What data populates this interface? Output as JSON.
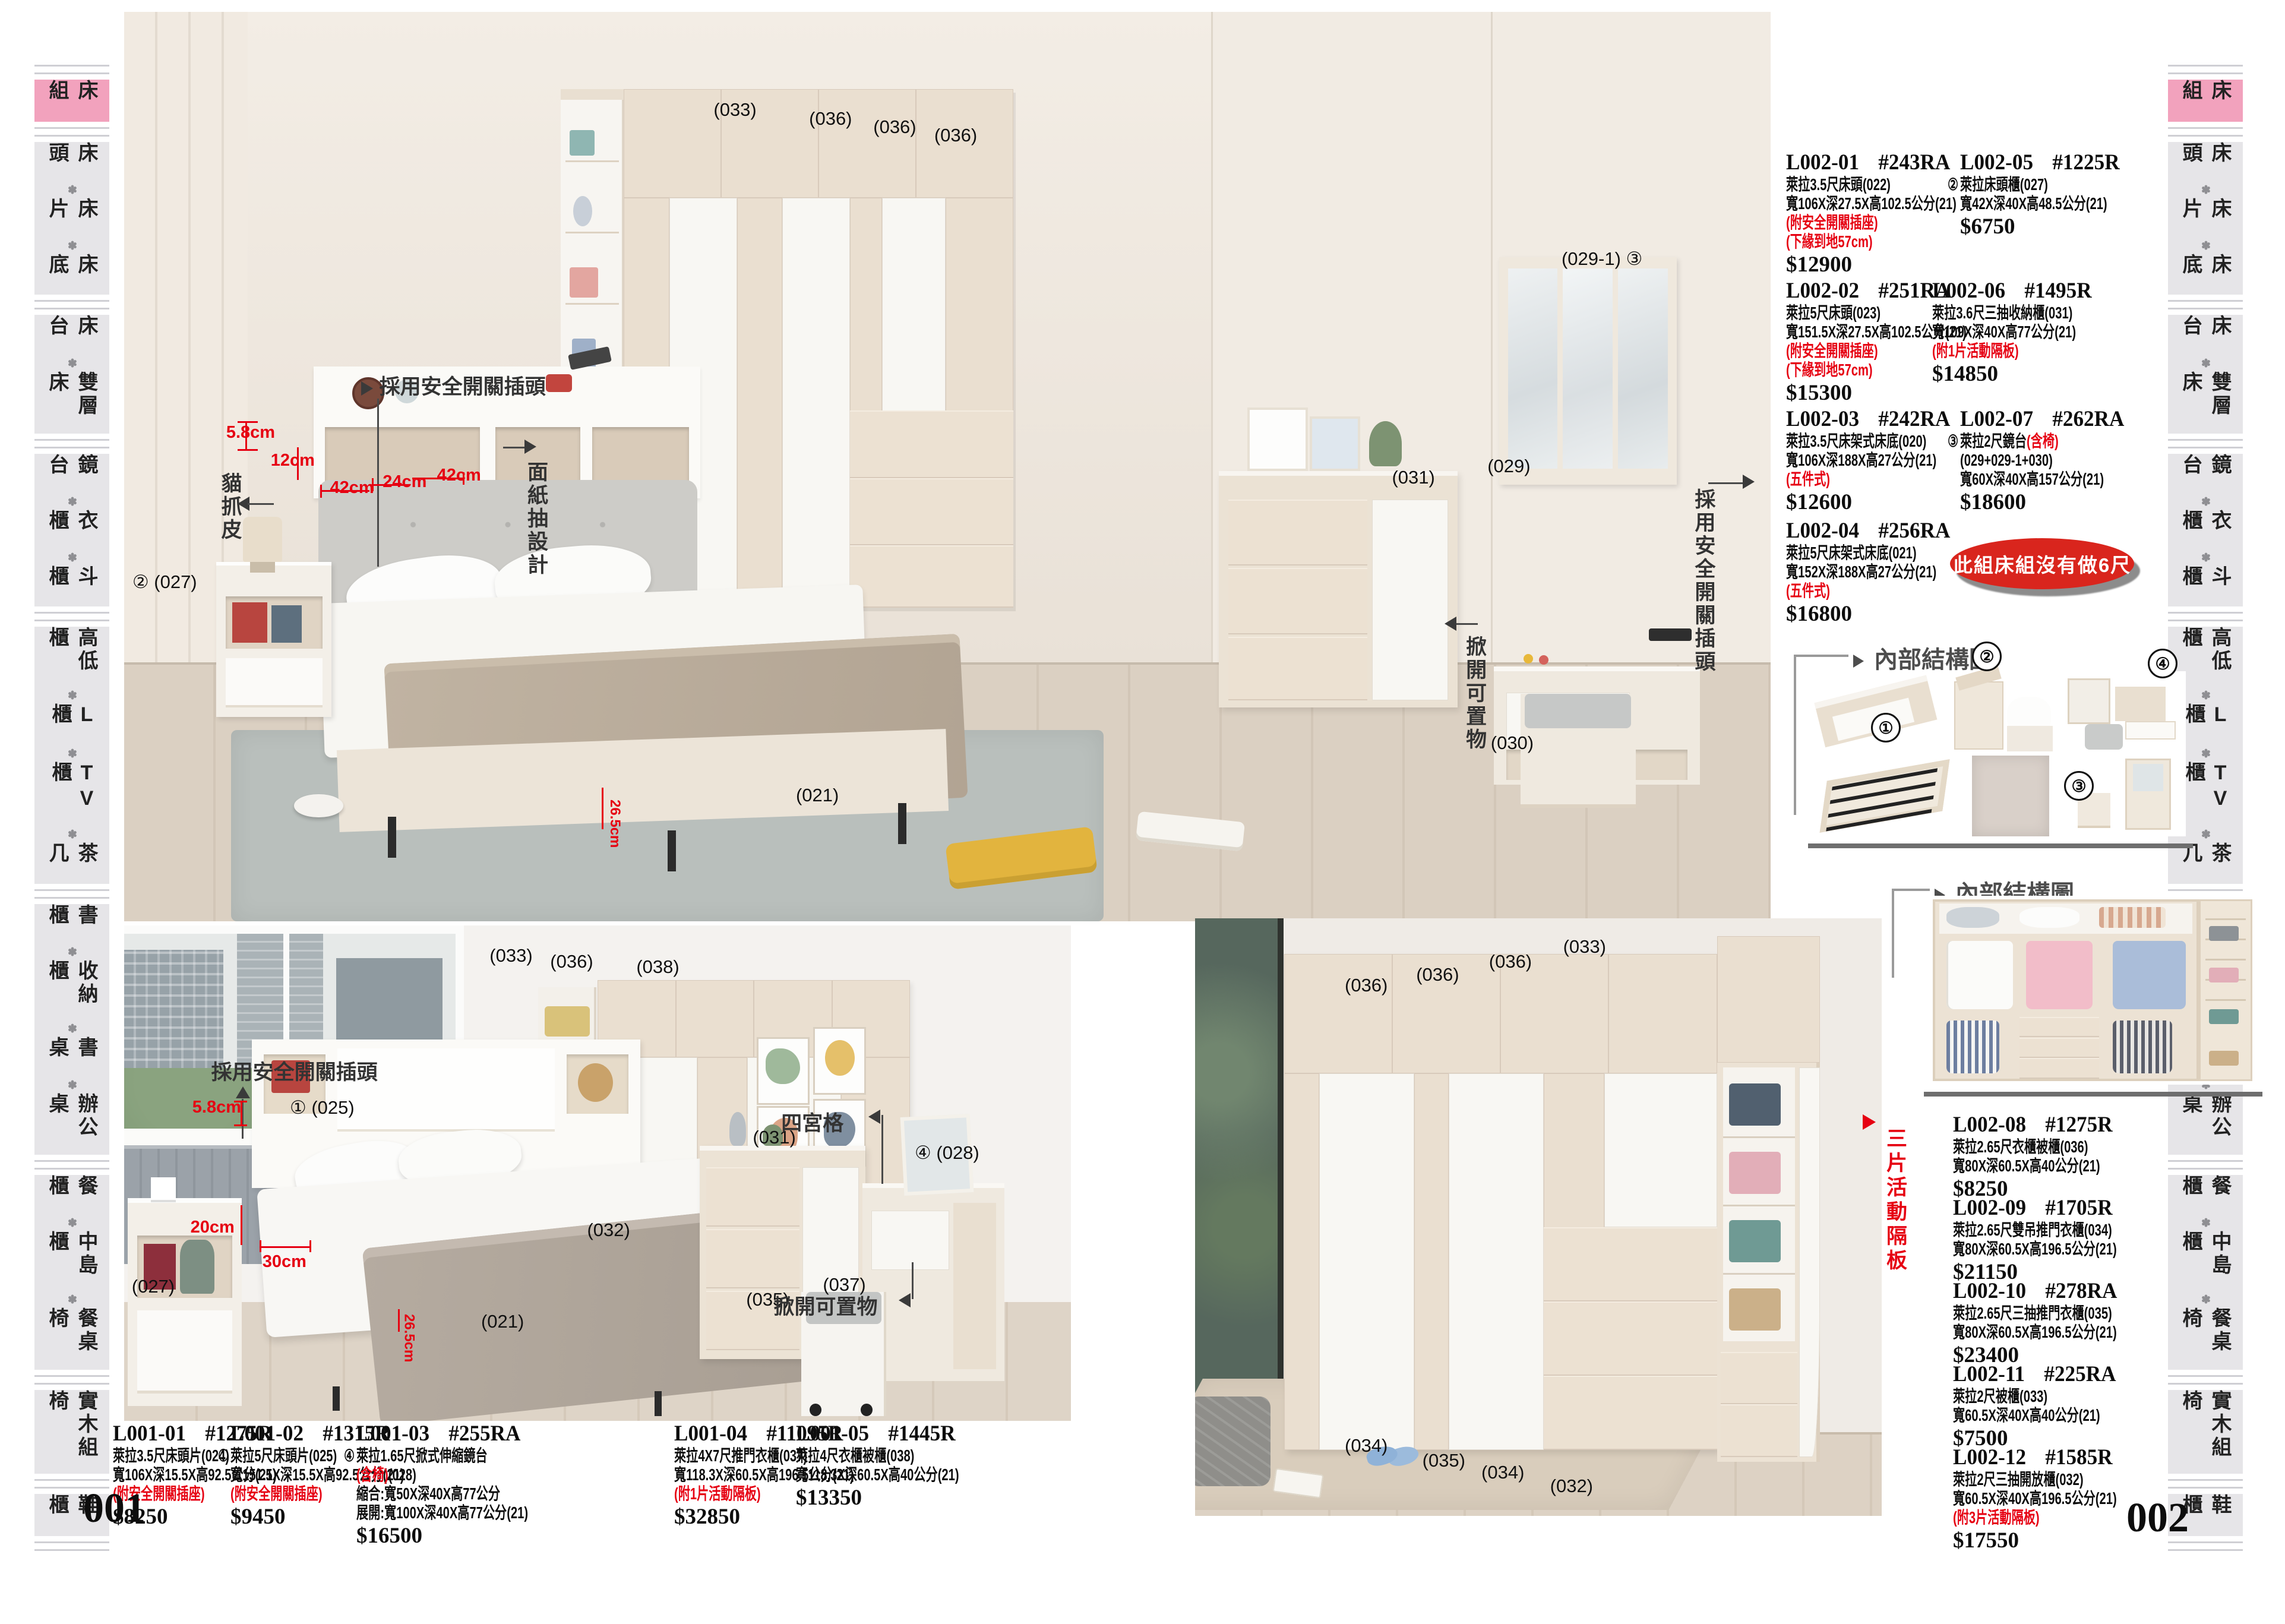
{
  "accent_colors": {
    "red": "#e60012",
    "pink": "#f2a2bd",
    "badge_red": "#d9251d"
  },
  "pages": {
    "left_number": "001",
    "right_number": "002"
  },
  "sidebar": {
    "separator": "✽",
    "items": [
      {
        "label": "床組",
        "active": true
      },
      {
        "label": "床頭✽床片✽床底",
        "active": false
      },
      {
        "label": "床台✽雙層床",
        "active": false
      },
      {
        "label": "鏡台✽衣櫃✽斗櫃",
        "active": false
      },
      {
        "label": "高低櫃✽L櫃✽TV櫃✽茶几",
        "active": false
      },
      {
        "label": "書櫃✽收納櫃✽書桌✽辦公桌",
        "active": false
      },
      {
        "label": "餐櫃✽中島櫃✽餐桌椅",
        "active": false
      },
      {
        "label": "實木組椅",
        "active": false
      },
      {
        "label": "鞋櫃",
        "active": false
      }
    ]
  },
  "products_l001": [
    {
      "code": "L001-01",
      "model": "#1275R",
      "lines": [
        {
          "segs": [
            {
              "t": "萊拉3.5尺床頭片(024)"
            }
          ]
        },
        {
          "segs": [
            {
              "t": "寬106X深15.5X高92.5公分(21)"
            }
          ]
        },
        {
          "segs": [
            {
              "t": "(附安全開關插座)",
              "red": true
            }
          ]
        }
      ],
      "price": "$8250"
    },
    {
      "code": "L001-02",
      "model": "#1315R",
      "lines": [
        {
          "circ": "①",
          "segs": [
            {
              "t": "萊拉5尺床頭片(025)"
            }
          ]
        },
        {
          "segs": [
            {
              "t": "寬151.5X深15.5X高92.5公分(21)"
            }
          ]
        },
        {
          "segs": [
            {
              "t": "(附安全開關插座)",
              "red": true
            }
          ]
        }
      ],
      "price": "$9450"
    },
    {
      "code": "L001-03",
      "model": "#255RA",
      "lines": [
        {
          "circ": "④",
          "segs": [
            {
              "t": "萊拉1.65尺掀式伸縮鏡台"
            }
          ]
        },
        {
          "segs": [
            {
              "t": "(含椅)",
              "red": true
            },
            {
              "t": "(028)"
            }
          ]
        },
        {
          "segs": [
            {
              "t": "縮合:寬50X深40X高77公分"
            }
          ]
        },
        {
          "segs": [
            {
              "t": "展開:寬100X深40X高77公分(21)"
            }
          ]
        }
      ],
      "price": "$16500"
    },
    {
      "code": "L001-04",
      "model": "#11095R",
      "lines": [
        {
          "segs": [
            {
              "t": "萊拉4X7尺推門衣櫃(037)"
            }
          ]
        },
        {
          "segs": [
            {
              "t": "寬118.3X深60.5X高196.5公分(21)"
            }
          ]
        },
        {
          "segs": [
            {
              "t": "(附1片活動隔板)",
              "red": true
            }
          ]
        }
      ],
      "price": "$32850"
    },
    {
      "code": "L001-05",
      "model": "#1445R",
      "lines": [
        {
          "segs": [
            {
              "t": "萊拉4尺衣櫃被櫃(038)"
            }
          ]
        },
        {
          "segs": [
            {
              "t": "寬118.3X深60.5X高40公分(21)"
            }
          ]
        }
      ],
      "price": "$13350"
    }
  ],
  "products_l002_main": [
    {
      "code": "L002-01",
      "model": "#243RA",
      "lines": [
        {
          "segs": [
            {
              "t": "萊拉3.5尺床頭(022)"
            }
          ]
        },
        {
          "segs": [
            {
              "t": "寬106X深27.5X高102.5公分(21)"
            }
          ]
        },
        {
          "segs": [
            {
              "t": "(附安全開關插座)",
              "red": true
            }
          ]
        },
        {
          "segs": [
            {
              "t": "(下緣到地57cm)",
              "red": true
            }
          ]
        }
      ],
      "price": "$12900"
    },
    {
      "code": "L002-05",
      "model": "#1225R",
      "lines": [
        {
          "circ": "②",
          "segs": [
            {
              "t": "萊拉床頭櫃(027)"
            }
          ]
        },
        {
          "segs": [
            {
              "t": "寬42X深40X高48.5公分(21)"
            }
          ]
        }
      ],
      "price": "$6750"
    },
    {
      "code": "L002-02",
      "model": "#251RA",
      "lines": [
        {
          "segs": [
            {
              "t": "萊拉5尺床頭(023)"
            }
          ]
        },
        {
          "segs": [
            {
              "t": "寬151.5X深27.5X高102.5公分(21)"
            }
          ]
        },
        {
          "segs": [
            {
              "t": "(附安全開關插座)",
              "red": true
            }
          ]
        },
        {
          "segs": [
            {
              "t": "(下緣到地57cm)",
              "red": true
            }
          ]
        }
      ],
      "price": "$15300"
    },
    {
      "code": "L002-06",
      "model": "#1495R",
      "lines": [
        {
          "segs": [
            {
              "t": "萊拉3.6尺三抽收納櫃(031)"
            }
          ]
        },
        {
          "segs": [
            {
              "t": "寬109X深40X高77公分(21)"
            }
          ]
        },
        {
          "segs": [
            {
              "t": "(附1片活動隔板)",
              "red": true
            }
          ]
        }
      ],
      "price": "$14850"
    },
    {
      "code": "L002-03",
      "model": "#242RA",
      "lines": [
        {
          "segs": [
            {
              "t": "萊拉3.5尺床架式床底(020)"
            }
          ]
        },
        {
          "segs": [
            {
              "t": "寬106X深188X高27公分(21)"
            }
          ]
        },
        {
          "segs": [
            {
              "t": "(五件式)",
              "red": true
            }
          ]
        }
      ],
      "price": "$12600"
    },
    {
      "code": "L002-07",
      "model": "#262RA",
      "lines": [
        {
          "circ": "③",
          "segs": [
            {
              "t": "萊拉2尺鏡台"
            },
            {
              "t": "(含椅)",
              "red": true
            }
          ]
        },
        {
          "segs": [
            {
              "t": "(029+029-1+030)"
            }
          ]
        },
        {
          "segs": [
            {
              "t": "寬60X深40X高157公分(21)"
            }
          ]
        }
      ],
      "price": "$18600"
    },
    {
      "code": "L002-04",
      "model": "#256RA",
      "lines": [
        {
          "segs": [
            {
              "t": "萊拉5尺床架式床底(021)"
            }
          ]
        },
        {
          "segs": [
            {
              "t": "寬152X深188X高27公分(21)"
            }
          ]
        },
        {
          "segs": [
            {
              "t": "(五件式)",
              "red": true
            }
          ]
        }
      ],
      "price": "$16800"
    }
  ],
  "products_l002_side": [
    {
      "code": "L002-08",
      "model": "#1275R",
      "lines": [
        {
          "segs": [
            {
              "t": "萊拉2.65尺衣櫃被櫃(036)"
            }
          ]
        },
        {
          "segs": [
            {
              "t": "寬80X深60.5X高40公分(21)"
            }
          ]
        }
      ],
      "price": "$8250"
    },
    {
      "code": "L002-09",
      "model": "#1705R",
      "lines": [
        {
          "segs": [
            {
              "t": "萊拉2.65尺雙吊推門衣櫃(034)"
            }
          ]
        },
        {
          "segs": [
            {
              "t": "寬80X深60.5X高196.5公分(21)"
            }
          ]
        }
      ],
      "price": "$21150"
    },
    {
      "code": "L002-10",
      "model": "#278RA",
      "lines": [
        {
          "segs": [
            {
              "t": "萊拉2.65尺三抽推門衣櫃(035)"
            }
          ]
        },
        {
          "segs": [
            {
              "t": "寬80X深60.5X高196.5公分(21)"
            }
          ]
        }
      ],
      "price": "$23400"
    },
    {
      "code": "L002-11",
      "model": "#225RA",
      "lines": [
        {
          "segs": [
            {
              "t": "萊拉2尺被櫃(033)"
            }
          ]
        },
        {
          "segs": [
            {
              "t": "寬60.5X深40X高40公分(21)"
            }
          ]
        }
      ],
      "price": "$7500"
    },
    {
      "code": "L002-12",
      "model": "#1585R",
      "lines": [
        {
          "segs": [
            {
              "t": "萊拉2尺三抽開放櫃(032)"
            }
          ]
        },
        {
          "segs": [
            {
              "t": "寬60.5X深40X高196.5公分(21)"
            }
          ]
        },
        {
          "segs": [
            {
              "t": "(附3片活動隔板)",
              "red": true
            }
          ]
        }
      ],
      "price": "$17550"
    }
  ],
  "badge_text": "此組床組沒有做6尺",
  "struct1": {
    "title": "內部結構圖",
    "num1": "①",
    "num2": "②",
    "num3": "③",
    "num4": "④"
  },
  "struct2": {
    "title": "內部結構圖"
  },
  "side_note_red": "三片活動隔板",
  "photoA": {
    "labels": [
      {
        "t": "(033)",
        "x": 35.8,
        "y": 9.6
      },
      {
        "t": "(036)",
        "x": 41.6,
        "y": 10.6
      },
      {
        "t": "(036)",
        "x": 45.5,
        "y": 11.5
      },
      {
        "t": "(036)",
        "x": 49.2,
        "y": 12.4
      },
      {
        "t": "② (027)",
        "x": 0.5,
        "y": 61.5
      },
      {
        "t": "(021)",
        "x": 40.8,
        "y": 85.0
      },
      {
        "t": "(031)",
        "x": 77.0,
        "y": 50.0
      },
      {
        "t": "(029-1)  ③",
        "x": 87.3,
        "y": 26.0
      },
      {
        "t": "(029)",
        "x": 82.8,
        "y": 48.8
      },
      {
        "t": "(030)",
        "x": 83.0,
        "y": 79.2
      }
    ],
    "notes": {
      "plug": "採用安全開關插頭",
      "cat": "貓抓皮",
      "tissue": "面紙抽設計",
      "lift": "掀開可置物",
      "plug2": "採用安全開關插頭"
    },
    "dims": {
      "d58": "5.8cm",
      "d12": "12cm",
      "d42a": "42cm",
      "d24": "24cm",
      "d42b": "42cm",
      "bedh": "26.5cm"
    }
  },
  "photoB": {
    "labels": [
      {
        "t": "(033)",
        "x": 38.6,
        "y": 4.0
      },
      {
        "t": "(036)",
        "x": 45.0,
        "y": 5.2
      },
      {
        "t": "(038)",
        "x": 54.1,
        "y": 6.2
      },
      {
        "t": "① (025)",
        "x": 17.5,
        "y": 34.6
      },
      {
        "t": "(027)",
        "x": 0.8,
        "y": 70.8
      },
      {
        "t": "(032)",
        "x": 48.9,
        "y": 59.4
      },
      {
        "t": "(035)",
        "x": 65.7,
        "y": 73.4
      },
      {
        "t": "(037)",
        "x": 73.8,
        "y": 70.4
      },
      {
        "t": "(031)",
        "x": 66.4,
        "y": 40.6
      },
      {
        "t": "④ (028)",
        "x": 83.5,
        "y": 43.8
      },
      {
        "t": "(021)",
        "x": 37.7,
        "y": 77.8
      }
    ],
    "notes": {
      "plug": "採用安全開關插頭",
      "grid": "四宮格",
      "lift": "掀開可置物"
    },
    "dims": {
      "d58": "5.8cm",
      "d20": "20cm",
      "d30": "30cm",
      "bedh": "26.5cm"
    }
  },
  "photoC": {
    "labels": [
      {
        "t": "(036)",
        "x": 21.8,
        "y": 9.4
      },
      {
        "t": "(036)",
        "x": 32.2,
        "y": 7.7
      },
      {
        "t": "(036)",
        "x": 42.8,
        "y": 5.5
      },
      {
        "t": "(033)",
        "x": 53.6,
        "y": 3.0
      },
      {
        "t": "(034)",
        "x": 21.8,
        "y": 86.5
      },
      {
        "t": "(035)",
        "x": 33.1,
        "y": 89.0
      },
      {
        "t": "(034)",
        "x": 41.7,
        "y": 91.0
      },
      {
        "t": "(032)",
        "x": 51.7,
        "y": 93.2
      }
    ]
  }
}
